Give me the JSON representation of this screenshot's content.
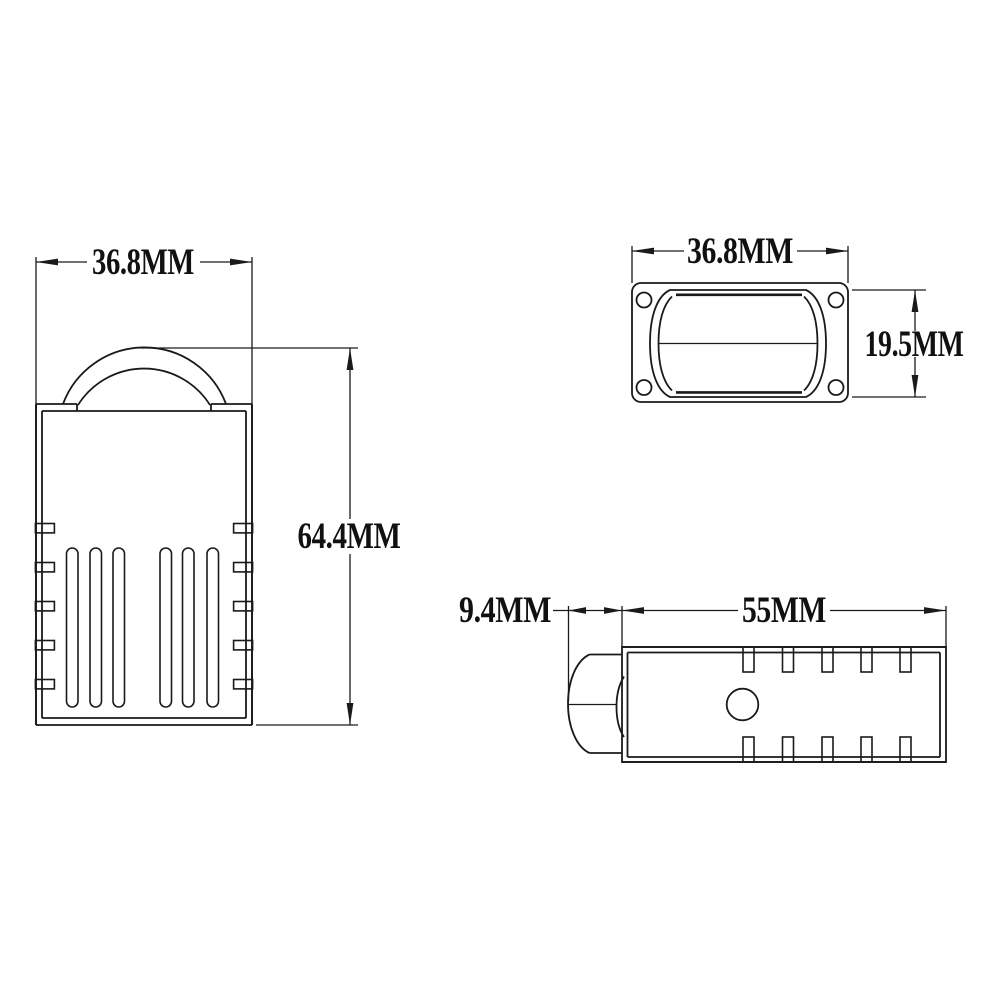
{
  "colors": {
    "background": "#ffffff",
    "line": "#1a1a1a",
    "text": "#111111"
  },
  "views": {
    "front": {
      "width_label": "36.8MM",
      "height_label": "64.4MM"
    },
    "top": {
      "width_label": "36.8MM",
      "height_label": "19.5MM"
    },
    "side": {
      "cap_label": "9.4MM",
      "length_label": "55MM"
    }
  }
}
